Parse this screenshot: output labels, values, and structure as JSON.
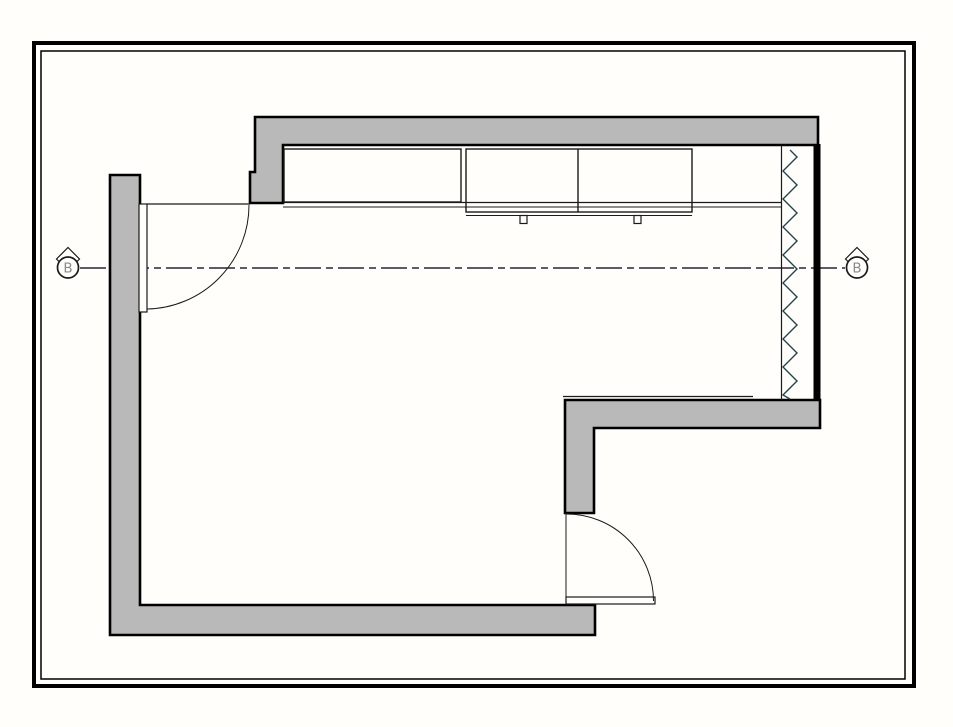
{
  "title": "architectural-floor-plan",
  "colors": {
    "paper": "#fffefa",
    "wall_fill": "#b9b9b9",
    "wall_stroke": "#000000",
    "thin_line": "#1a1a1a",
    "insulation": "#24454e",
    "centerline": "#26263a",
    "marker_text": "#8a8a8a"
  },
  "markers": {
    "left_label": "B",
    "right_label": "B"
  },
  "drawing": {
    "width": 953,
    "height": 727,
    "elements": [
      {
        "type": "rect",
        "name": "drawing-border-outer",
        "attrs": {
          "x": 34,
          "y": 43,
          "width": 880,
          "height": 643,
          "fill": "none",
          "stroke": "#000000",
          "stroke-width": 4
        }
      },
      {
        "type": "rect",
        "name": "drawing-border-inner",
        "attrs": {
          "x": 41,
          "y": 51,
          "width": 864,
          "height": 628,
          "fill": "none",
          "stroke": "#000000",
          "stroke-width": 1.5
        }
      },
      {
        "type": "line",
        "name": "section-centerline",
        "attrs": {
          "x1": 80,
          "y1": 268,
          "x2": 845,
          "y2": 268,
          "stroke": "#26263a",
          "stroke-width": 1.4,
          "stroke-dasharray": "26 5 7 5",
          "fill": "none"
        }
      },
      {
        "type": "polygon",
        "name": "wall-top",
        "attrs": {
          "points": "255,117 818,117 818,145 283,145 283,203 250,203 250,172 255,172",
          "fill": "#b9b9b9",
          "stroke": "#000000",
          "stroke-width": 2.6
        }
      },
      {
        "type": "rect",
        "name": "wall-right",
        "attrs": {
          "x": 813.5,
          "y": 144,
          "width": 7,
          "height": 258,
          "fill": "#000000",
          "stroke": "none"
        }
      },
      {
        "type": "polygon",
        "name": "wall-left-bottom",
        "attrs": {
          "points": "110,175 140,175 140,605 595,605 595,635 110,635",
          "fill": "#b9b9b9",
          "stroke": "#000000",
          "stroke-width": 2.6
        }
      },
      {
        "type": "polygon",
        "name": "wall-step",
        "attrs": {
          "points": "565,400 820,400 820,428 594,428 594,513 565,513",
          "fill": "#b9b9b9",
          "stroke": "#000000",
          "stroke-width": 2.6
        }
      },
      {
        "type": "line",
        "name": "countertop-edge-upper",
        "attrs": {
          "x1": 283,
          "y1": 202.5,
          "x2": 782,
          "y2": 202.5,
          "stroke": "#1a1a1a",
          "stroke-width": 1.3
        }
      },
      {
        "type": "line",
        "name": "countertop-edge-lower",
        "attrs": {
          "x1": 283,
          "y1": 207,
          "x2": 782,
          "y2": 207,
          "stroke": "#1a1a1a",
          "stroke-width": 1
        }
      },
      {
        "type": "rect",
        "name": "cabinet-unit-left",
        "attrs": {
          "x": 284,
          "y": 149,
          "width": 177,
          "height": 53,
          "fill": "none",
          "stroke": "#1a1a1a",
          "stroke-width": 1.4
        }
      },
      {
        "type": "rect",
        "name": "cabinet-unit-right",
        "attrs": {
          "x": 466,
          "y": 149,
          "width": 226,
          "height": 63,
          "fill": "none",
          "stroke": "#1a1a1a",
          "stroke-width": 1.4
        }
      },
      {
        "type": "line",
        "name": "cabinet-divider-line",
        "attrs": {
          "x1": 578,
          "y1": 149,
          "x2": 578,
          "y2": 212,
          "stroke": "#1a1a1a",
          "stroke-width": 1.4
        }
      },
      {
        "type": "line",
        "name": "cabinet-front-edge",
        "attrs": {
          "x1": 466,
          "y1": 215.5,
          "x2": 692,
          "y2": 215.5,
          "stroke": "#1a1a1a",
          "stroke-width": 1
        }
      },
      {
        "type": "rect",
        "name": "cabinet-handle-left",
        "attrs": {
          "x": 520,
          "y": 215.5,
          "width": 7,
          "height": 8,
          "fill": "#fffefa",
          "stroke": "#1a1a1a",
          "stroke-width": 1.2
        }
      },
      {
        "type": "rect",
        "name": "cabinet-handle-right",
        "attrs": {
          "x": 634,
          "y": 215.5,
          "width": 7,
          "height": 8,
          "fill": "#fffefa",
          "stroke": "#1a1a1a",
          "stroke-width": 1.2
        }
      },
      {
        "type": "line",
        "name": "door-opening-head-left",
        "attrs": {
          "x1": 147,
          "y1": 204,
          "x2": 250,
          "y2": 204,
          "stroke": "#1a1a1a",
          "stroke-width": 1.2
        }
      },
      {
        "type": "rect",
        "name": "door-leaf-left",
        "attrs": {
          "x": 139,
          "y": 204,
          "width": 8,
          "height": 108,
          "fill": "#fffefa",
          "stroke": "#1a1a1a",
          "stroke-width": 1.2
        }
      },
      {
        "type": "path",
        "name": "door-swing-left",
        "attrs": {
          "d": "M 249,205 A 104,104 0 0 1 147,309",
          "fill": "none",
          "stroke": "#1a1a1a",
          "stroke-width": 1
        }
      },
      {
        "type": "line",
        "name": "window-frame-line",
        "attrs": {
          "x1": 781.5,
          "y1": 146,
          "x2": 781.5,
          "y2": 400,
          "stroke": "#1a1a1a",
          "stroke-width": 1.2
        }
      },
      {
        "type": "polyline",
        "name": "insulation-zigzag",
        "attrs": {
          "points": "790,150 797,157 783,171 797,185 783,199 797,213 783,227 797,241 783,255 797,269 783,283 797,297 783,311 797,325 783,339 797,353 783,367 797,381 783,395 790,399",
          "fill": "none",
          "stroke": "#24454e",
          "stroke-width": 1.4
        }
      },
      {
        "type": "line",
        "name": "counter-edge-step-wall",
        "attrs": {
          "x1": 563,
          "y1": 396.5,
          "x2": 753,
          "y2": 396.5,
          "stroke": "#1a1a1a",
          "stroke-width": 1.2
        }
      },
      {
        "type": "line",
        "name": "door-jamb-bottom",
        "attrs": {
          "x1": 566,
          "y1": 513,
          "x2": 566,
          "y2": 597,
          "stroke": "#1a1a1a",
          "stroke-width": 1
        }
      },
      {
        "type": "rect",
        "name": "door-leaf-bottom",
        "attrs": {
          "x": 566,
          "y": 597,
          "width": 89,
          "height": 7,
          "fill": "#fffefa",
          "stroke": "#1a1a1a",
          "stroke-width": 1.2
        }
      },
      {
        "type": "path",
        "name": "door-swing-bottom",
        "attrs": {
          "d": "M 566.5,514 A 87,87 0 0 1 653.5,601",
          "fill": "none",
          "stroke": "#1a1a1a",
          "stroke-width": 1
        }
      },
      {
        "type": "polygon",
        "name": "section-marker-left-diamond",
        "attrs": {
          "points": "68,247.5 79.5,259 68,270.5 56.5,259",
          "fill": "#fffefa",
          "stroke": "#1a1a1a",
          "stroke-width": 1.2
        }
      },
      {
        "type": "circle",
        "name": "section-marker-left-circle",
        "attrs": {
          "cx": 68,
          "cy": 267.5,
          "r": 10.5,
          "fill": "#fffefa",
          "stroke": "#1a1a1a",
          "stroke-width": 1.7
        }
      },
      {
        "type": "text",
        "name": "section-marker-left-label",
        "bind": "markers.left_label",
        "attrs": {
          "x": 68,
          "y": 272.5,
          "text-anchor": "middle",
          "font-size": "13.5",
          "fill": "#8a8a8a"
        }
      },
      {
        "type": "polygon",
        "name": "section-marker-right-diamond",
        "attrs": {
          "points": "857,247.5 868.5,259 857,270.5 845.5,259",
          "fill": "#fffefa",
          "stroke": "#1a1a1a",
          "stroke-width": 1.2
        }
      },
      {
        "type": "circle",
        "name": "section-marker-right-circle",
        "attrs": {
          "cx": 857,
          "cy": 267.5,
          "r": 10.5,
          "fill": "#fffefa",
          "stroke": "#1a1a1a",
          "stroke-width": 1.7
        }
      },
      {
        "type": "text",
        "name": "section-marker-right-label",
        "bind": "markers.right_label",
        "attrs": {
          "x": 857,
          "y": 272.5,
          "text-anchor": "middle",
          "font-size": "13.5",
          "fill": "#8a8a8a"
        }
      }
    ]
  }
}
